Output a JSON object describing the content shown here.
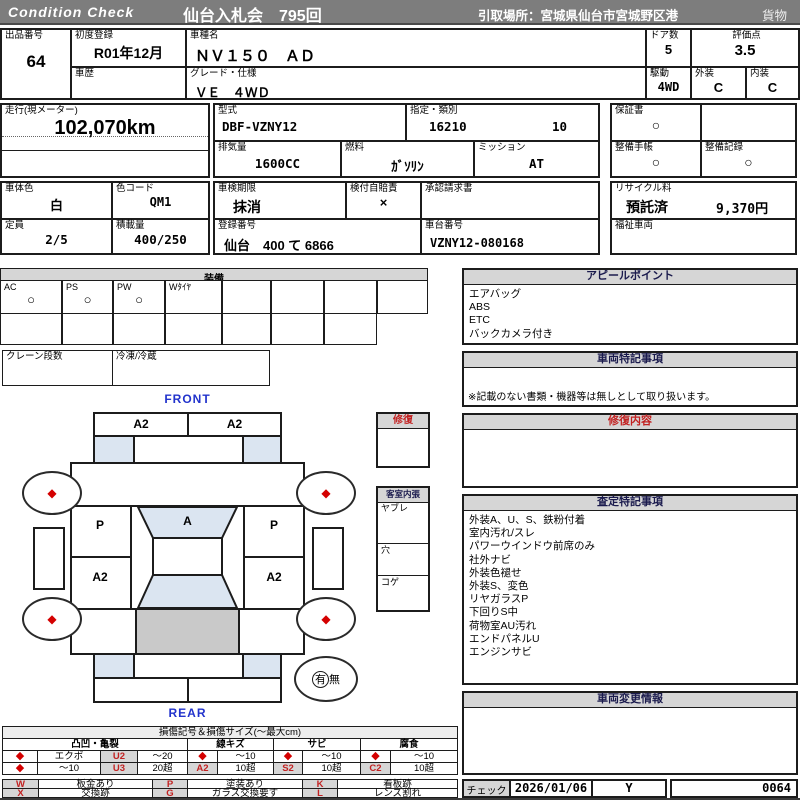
{
  "colors": {
    "top_bar": "#7d7d7d",
    "section_header_bg": "#d6d6d6",
    "accent_red": "#c22222",
    "marker_red": "#d40000",
    "label_blue": "#2233cc",
    "shade_blue": "#dbe5f1",
    "shade_gray": "#c9c9c9"
  },
  "header": {
    "brand": "Condition  Check",
    "title": "仙台入札会　795回",
    "pickup": "引取場所：宮城県仙台市宮城野区港",
    "category": "貨物"
  },
  "info": {
    "lot_label": "出品番号",
    "lot": "64",
    "first_reg_label": "初度登録",
    "first_reg": "R01年12月",
    "history_label": "車歴",
    "model_name_label": "車種名",
    "model_name": "ＮＶ１５０　ＡＤ",
    "grade_label": "グレード・仕様",
    "grade": "ＶＥ　４ＷＤ",
    "doors_label": "ドア数",
    "doors": "5",
    "drive_label": "駆動",
    "drive": "4WD",
    "score_label": "評価点",
    "score": "3.5",
    "exterior_label": "外装",
    "exterior": "C",
    "interior_label": "内装",
    "interior": "C",
    "mileage_label": "走行(現メーター)",
    "mileage": "102,070km",
    "model_code_label": "型式",
    "model_code": "DBF-VZNY12",
    "class_label": "指定・類別",
    "class1": "16210",
    "class2": "10",
    "displacement_label": "排気量",
    "displacement": "1600CC",
    "fuel_label": "燃料",
    "fuel": "ｶﾞｿﾘﾝ",
    "mission_label": "ミッション",
    "mission": "AT",
    "warranty_label": "保証書",
    "warranty": "○",
    "maintenance_book_label": "整備手帳",
    "maintenance_book": "○",
    "maintenance_record_label": "整備記録",
    "maintenance_record": "○",
    "color_label": "車体色",
    "color": "白",
    "color_code_label": "色コード",
    "color_code": "QM1",
    "capacity_label": "定員",
    "capacity": "2/5",
    "load_label": "積載量",
    "load": "400/250",
    "inspection_label": "車検期限",
    "inspection": "抹消",
    "insurance_label": "検付自賠責",
    "insurance": "×",
    "approval_label": "承認請求書",
    "reg_no_label": "登録番号",
    "reg_no": "仙台　400 て 6866",
    "chassis_label": "車台番号",
    "chassis": "VZNY12-080168",
    "recycle_label": "リサイクル料",
    "recycle_status": "預託済",
    "recycle_fee": "9,370円",
    "welfare_label": "福祉車両"
  },
  "equipment": {
    "title": "装備",
    "items": [
      {
        "label": "AC",
        "value": "○"
      },
      {
        "label": "PS",
        "value": "○"
      },
      {
        "label": "PW",
        "value": "○"
      },
      {
        "label": "Wﾀｲﾔ",
        "value": ""
      }
    ],
    "crane_label": "クレーン段数",
    "reefer_label": "冷凍/冷蔵"
  },
  "diagram": {
    "front_label": "FRONT",
    "rear_label": "REAR",
    "front_bumper_left": "A2",
    "front_bumper_right": "A2",
    "fender_left": "P",
    "fender_right": "P",
    "hood": "A",
    "door_left": "A2",
    "door_right": "A2",
    "wheel_marker": "◆",
    "presence_yes": "有",
    "presence_no": "無",
    "repair_title": "修復",
    "interior_title": "客室内張",
    "interior_rows": [
      "ヤブレ",
      "穴",
      "コゲ"
    ]
  },
  "right": {
    "appeal": {
      "title": "アピールポイント",
      "items": [
        "エアバッグ",
        "ABS",
        "ETC",
        "バックカメラ付き"
      ]
    },
    "notes": {
      "title": "車両特記事項",
      "note": "※記載のない書類・機器等は無しとして取り扱います。"
    },
    "repair": {
      "title": "修復内容"
    },
    "assessment": {
      "title": "査定特記事項",
      "items": [
        "外装A、U、S、鉄粉付着",
        "室内汚れ/スレ",
        "パワーウインドウ前席のみ",
        "社外ナビ",
        "外装色褪せ",
        "外装S、変色",
        "リヤガラスP",
        "下回りS中",
        "荷物室AU汚れ",
        "エンドパネルU",
        "エンジンサビ"
      ]
    },
    "change": {
      "title": "車両変更情報"
    },
    "check": {
      "label": "チェック",
      "date": "2026/01/06",
      "inspector": "Y",
      "number": "0064"
    }
  },
  "legend": {
    "title": "損傷記号＆損傷サイズ(〜最大cm)",
    "groups": [
      "凸凹・亀裂",
      "線キズ",
      "サビ",
      "腐食"
    ],
    "row1": [
      "◆",
      "エクボ",
      "U2",
      "〜20",
      "◆",
      "〜10",
      "◆",
      "〜10",
      "◆",
      "〜10"
    ],
    "row2": [
      "◆",
      "〜10",
      "U3",
      "20超",
      "A2",
      "10超",
      "S2",
      "10超",
      "C2",
      "10超"
    ],
    "letters_row1": [
      [
        "W",
        "板金あり"
      ],
      [
        "P",
        "塗装あり"
      ],
      [
        "K",
        "看板跡"
      ]
    ],
    "letters_row2": [
      [
        "X",
        "交換跡"
      ],
      [
        "G",
        "ガラス交換要す"
      ],
      [
        "L",
        "レンズ割れ"
      ]
    ]
  }
}
